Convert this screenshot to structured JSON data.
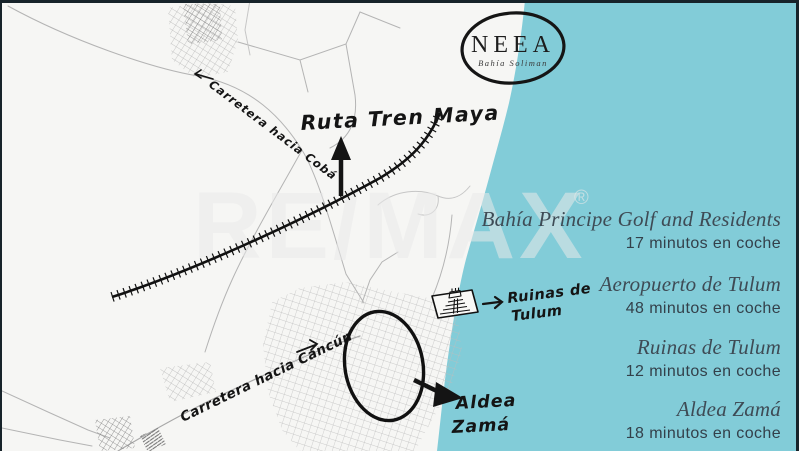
{
  "brand": {
    "name": "NEEA",
    "subtitle": "Bahía Soliman"
  },
  "watermark": {
    "text": "RE/MAX",
    "registered": "®"
  },
  "map": {
    "labels": {
      "train_route": "Ruta Tren Maya",
      "road_coba": "Carretera hacia Cobá",
      "road_cancun": "Carretera hacia Cancún",
      "ruins_line1": "Ruinas de",
      "ruins_line2": "Tulum",
      "aldea_line1": "Aldea",
      "aldea_line2": "Zamá"
    },
    "colors": {
      "ocean": "#82ccd8",
      "land": "#f6f6f4",
      "road": "#b4b4b4",
      "ink": "#141414",
      "heading_text": "#3e4b55",
      "body_text": "#33404a",
      "watermark": "#e9e9e9"
    }
  },
  "destinations": [
    {
      "name": "Bahía Principe Golf and Residents",
      "time": "17 minutos en coche"
    },
    {
      "name": "Aeropuerto de Tulum",
      "time": "48 minutos en coche"
    },
    {
      "name": "Ruinas de Tulum",
      "time": "12 minutos en coche"
    },
    {
      "name": "Aldea Zamá",
      "time": "18 minutos en coche"
    }
  ]
}
